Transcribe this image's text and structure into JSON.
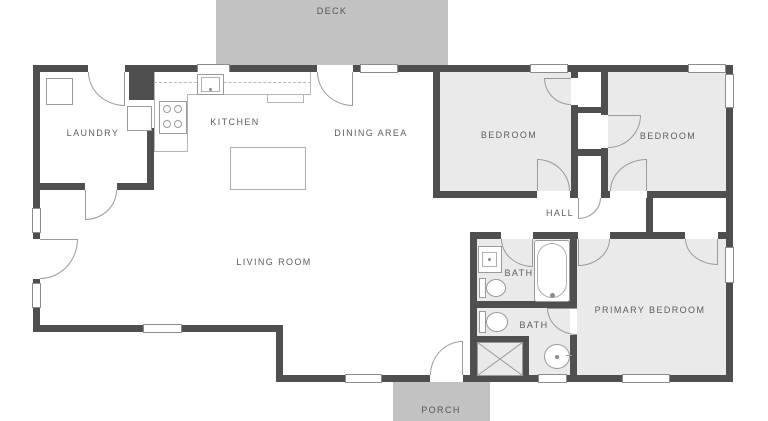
{
  "floor_plan": {
    "outdoor": {
      "deck": "DECK",
      "porch": "PORCH"
    },
    "rooms": {
      "laundry": "LAUNDRY",
      "kitchen": "KITCHEN",
      "dining": "DINING AREA",
      "living": "LIVING ROOM",
      "bedroom_left": "BEDROOM",
      "bedroom_right": "BEDROOM",
      "hall": "HALL",
      "bath_top": "BATH",
      "bath_bottom": "BATH",
      "primary_bedroom": "PRIMARY BEDROOM"
    },
    "colors": {
      "wall": "#4f4f4f",
      "room_fill": "#eaeaea",
      "outdoor_fill": "#c2c2c2",
      "line": "#9a9a9a",
      "label_text": "#5d5d5d"
    }
  }
}
